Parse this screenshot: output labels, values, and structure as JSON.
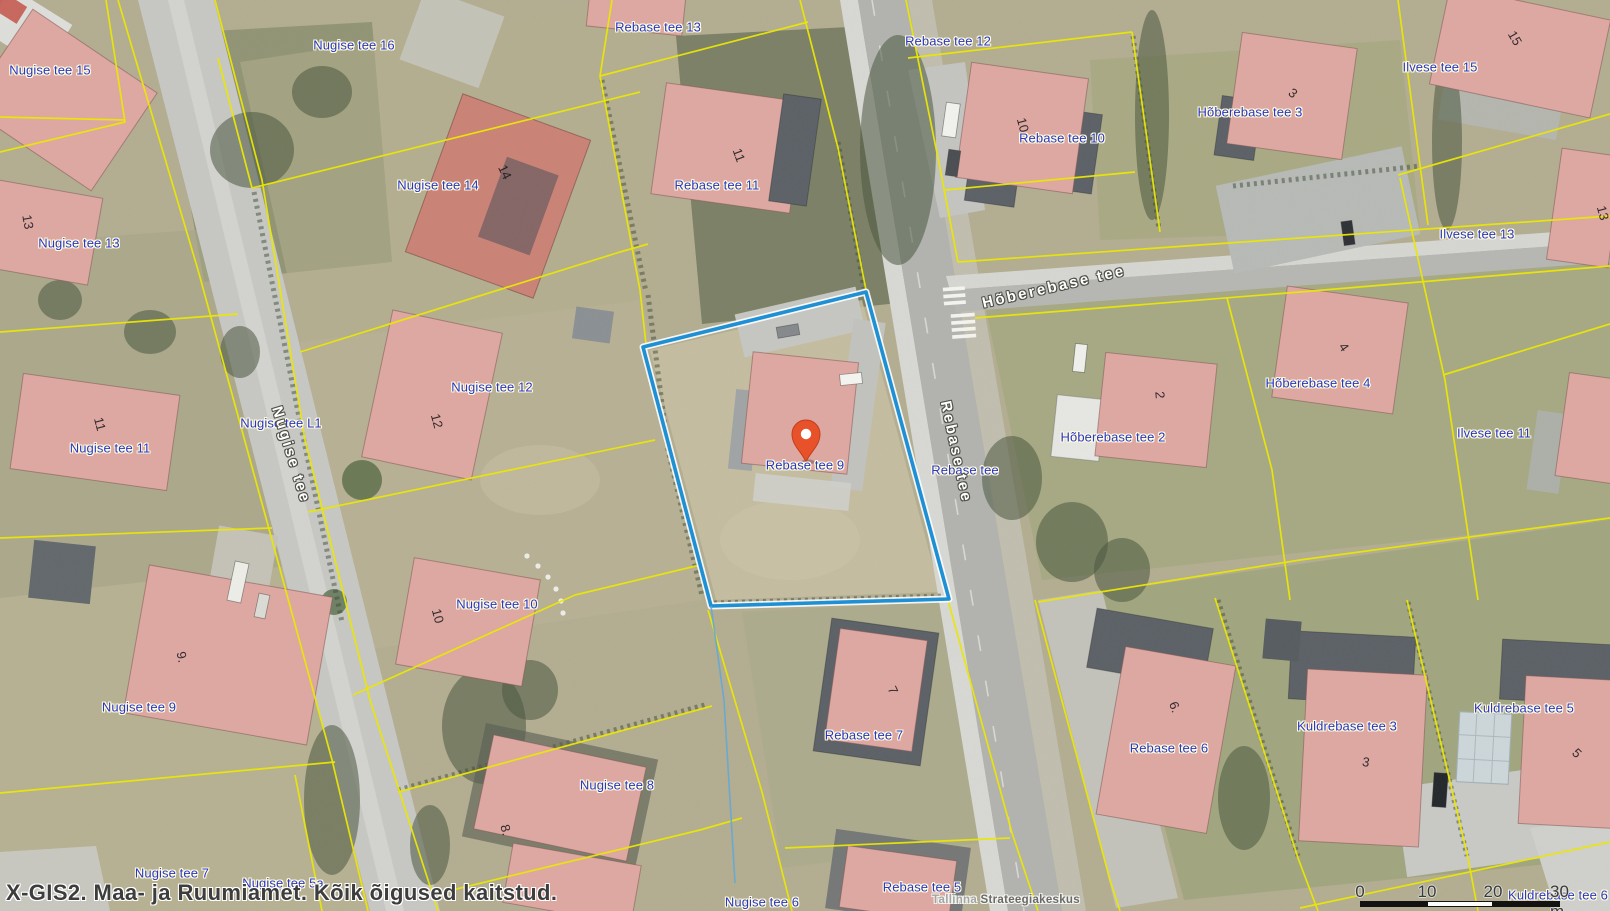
{
  "app": {
    "watermark_left": "X-GIS2. Maa- ja Ruumiamet. Kõik õigused kaitstud.",
    "watermark_center_light": "Tallinna",
    "watermark_center_dark": "Strateegiakeskus"
  },
  "colors": {
    "parcel_line": "#ece800",
    "highlight": "#1b8fd6",
    "pin": "#e8522b",
    "parcel_label": "#2737c9",
    "label_halo": "#fffbdc",
    "street_label": "#ffffff",
    "street_halo": "#52524b",
    "watermark": "#3d3d3d"
  },
  "marker": {
    "label": "Rebase tee 9"
  },
  "scalebar": {
    "ticks": [
      "0",
      "10",
      "20",
      "30 m"
    ]
  },
  "map": {
    "labels": [
      {
        "t": "Nugise tee 15",
        "x": 50,
        "y": 70,
        "k": "parcel"
      },
      {
        "t": "Nugise tee 16",
        "x": 354,
        "y": 45,
        "k": "parcel"
      },
      {
        "t": "Rebase tee 13",
        "x": 658,
        "y": 27,
        "k": "parcel"
      },
      {
        "t": "Rebase tee 12",
        "x": 948,
        "y": 41,
        "k": "parcel"
      },
      {
        "t": "Ilvese tee 15",
        "x": 1440,
        "y": 67,
        "k": "parcel"
      },
      {
        "t": "Hõberebase tee 3",
        "x": 1250,
        "y": 112,
        "k": "parcel"
      },
      {
        "t": "Rebase tee 10",
        "x": 1062,
        "y": 138,
        "k": "parcel"
      },
      {
        "t": "Nugise tee 14",
        "x": 438,
        "y": 185,
        "k": "parcel"
      },
      {
        "t": "Rebase tee 11",
        "x": 717,
        "y": 185,
        "k": "parcel"
      },
      {
        "t": "Nugise tee 13",
        "x": 79,
        "y": 243,
        "k": "parcel"
      },
      {
        "t": "Ilvese tee 13",
        "x": 1477,
        "y": 234,
        "k": "parcel"
      },
      {
        "t": "Nugise tee 12",
        "x": 492,
        "y": 387,
        "k": "parcel"
      },
      {
        "t": "Nugise tee L1",
        "x": 281,
        "y": 423,
        "k": "parcel"
      },
      {
        "t": "Hõberebase tee 4",
        "x": 1318,
        "y": 383,
        "k": "parcel"
      },
      {
        "t": "Hõberebase tee 2",
        "x": 1113,
        "y": 437,
        "k": "parcel"
      },
      {
        "t": "Ilvese tee 11",
        "x": 1494,
        "y": 433,
        "k": "parcel"
      },
      {
        "t": "Nugise tee 11",
        "x": 110,
        "y": 448,
        "k": "parcel"
      },
      {
        "t": "Rebase tee",
        "x": 965,
        "y": 470,
        "k": "parcel"
      },
      {
        "t": "Rebase tee 9",
        "x": 805,
        "y": 465,
        "k": "parcel"
      },
      {
        "t": "Nugise tee 10",
        "x": 497,
        "y": 604,
        "k": "parcel"
      },
      {
        "t": "Nugise tee 9",
        "x": 139,
        "y": 707,
        "k": "parcel"
      },
      {
        "t": "Kuldrebase tee 5",
        "x": 1524,
        "y": 708,
        "k": "parcel"
      },
      {
        "t": "Kuldrebase tee 3",
        "x": 1347,
        "y": 726,
        "k": "parcel"
      },
      {
        "t": "Rebase tee 7",
        "x": 864,
        "y": 735,
        "k": "parcel"
      },
      {
        "t": "Rebase tee 6",
        "x": 1169,
        "y": 748,
        "k": "parcel"
      },
      {
        "t": "Nugise tee 8",
        "x": 617,
        "y": 785,
        "k": "parcel"
      },
      {
        "t": "Nugise tee 7",
        "x": 172,
        "y": 873,
        "k": "parcel"
      },
      {
        "t": "Nugise tee 5a",
        "x": 283,
        "y": 883,
        "k": "parcel"
      },
      {
        "t": "Rebase tee 5",
        "x": 922,
        "y": 887,
        "k": "parcel"
      },
      {
        "t": "Nugise tee 6",
        "x": 762,
        "y": 902,
        "k": "parcel"
      },
      {
        "t": "Kuldrebase tee 6",
        "x": 1558,
        "y": 895,
        "k": "parcel"
      },
      {
        "t": "Hõberebase tee",
        "x": 1054,
        "y": 287,
        "k": "street",
        "r": -13
      },
      {
        "t": "Nugise tee",
        "x": 291,
        "y": 455,
        "k": "street",
        "r": 73
      },
      {
        "t": "Rebase tee",
        "x": 956,
        "y": 452,
        "k": "street",
        "r": 78
      },
      {
        "t": "13",
        "x": 28,
        "y": 222,
        "k": "num",
        "r": 80
      },
      {
        "t": "11",
        "x": 100,
        "y": 424,
        "k": "num",
        "r": 75
      },
      {
        "t": "9.",
        "x": 182,
        "y": 657,
        "k": "num",
        "r": 78
      },
      {
        "t": "14",
        "x": 505,
        "y": 172,
        "k": "num",
        "r": 65
      },
      {
        "t": "12",
        "x": 437,
        "y": 421,
        "k": "num",
        "r": 75
      },
      {
        "t": "10",
        "x": 438,
        "y": 616,
        "k": "num",
        "r": 75
      },
      {
        "t": "10",
        "x": 1023,
        "y": 125,
        "k": "num",
        "r": 75
      },
      {
        "t": "8.",
        "x": 506,
        "y": 830,
        "k": "num",
        "r": 75
      },
      {
        "t": "11",
        "x": 739,
        "y": 155,
        "k": "num",
        "r": 70
      },
      {
        "t": "7",
        "x": 893,
        "y": 690,
        "k": "num",
        "r": 65
      },
      {
        "t": "2",
        "x": 1160,
        "y": 395,
        "k": "num",
        "r": 85
      },
      {
        "t": "4",
        "x": 1344,
        "y": 347,
        "k": "num",
        "r": 55
      },
      {
        "t": "3",
        "x": 1293,
        "y": 93,
        "k": "num",
        "r": 40
      },
      {
        "t": "15",
        "x": 1515,
        "y": 38,
        "k": "num",
        "r": 60
      },
      {
        "t": "13",
        "x": 1603,
        "y": 213,
        "k": "num",
        "r": 75
      },
      {
        "t": "6.",
        "x": 1175,
        "y": 707,
        "k": "num",
        "r": 70
      },
      {
        "t": "3",
        "x": 1366,
        "y": 762,
        "k": "num",
        "r": 10
      },
      {
        "t": "5",
        "x": 1577,
        "y": 753,
        "k": "num",
        "r": 45
      }
    ]
  }
}
